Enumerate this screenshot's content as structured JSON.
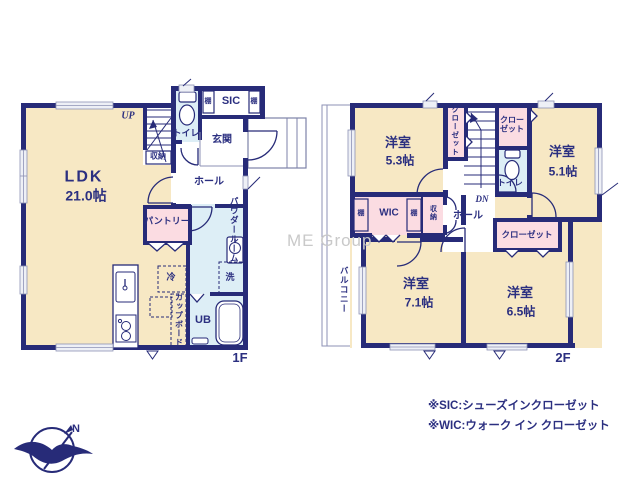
{
  "watermark": "ME Group",
  "compass": {
    "label": "N"
  },
  "floor1": {
    "label": "1F",
    "ldk": {
      "name": "LDK",
      "size": "21.0帖"
    },
    "stairs": "UP",
    "storage": "収納",
    "toilet": "トイレ",
    "shelf_left": "棚",
    "sic": "SIC",
    "shelf_right": "棚",
    "entrance": "玄関",
    "hall": "ホール",
    "pantry": "パントリー",
    "powder_room": "パウダールーム",
    "fridge": "冷",
    "washer": "洗",
    "unit_bath": "UB",
    "cupboard": "カップボード"
  },
  "floor2": {
    "label": "2F",
    "room_53": {
      "name": "洋室",
      "size": "5.3帖"
    },
    "closet_left": "クローゼット",
    "closet_center": "クローゼット",
    "toilet": "トイレ",
    "room_51": {
      "name": "洋室",
      "size": "5.1帖"
    },
    "stairs": "DN",
    "hall": "ホール",
    "shelf_left": "棚",
    "wic": "WIC",
    "shelf_right": "棚",
    "storage": "収納",
    "closet_right": "クローゼット",
    "room_71": {
      "name": "洋室",
      "size": "7.1帖"
    },
    "room_65": {
      "name": "洋室",
      "size": "6.5帖"
    },
    "balcony": "バルコニー"
  },
  "notes": {
    "sic": "※SIC:シューズインクローゼット",
    "wic": "※WIC:ウォーク イン クローゼット"
  },
  "colors": {
    "wall": "#272b78",
    "room_beige": "#f7e8c4",
    "room_pink": "#fbdce2",
    "room_blue": "#ddeef6",
    "text": "#2b2f80",
    "watermark": "#c9c9c9"
  }
}
